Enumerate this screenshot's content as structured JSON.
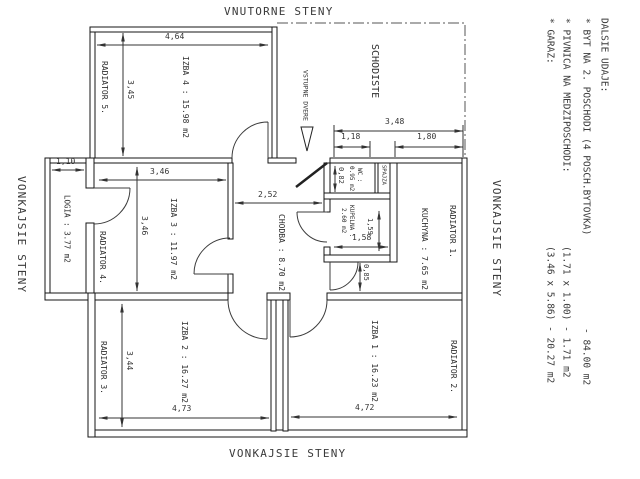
{
  "drawing": {
    "wall_labels": {
      "top": "VNUTORNE STENY",
      "left": "VONKAJSIE STENY",
      "right": "VONKAJSIE STENY",
      "bottom": "VONKAJSIE STENY"
    },
    "staircase_label": "SCHODISTE",
    "entrance_label": "VSTUPNE DVERE",
    "rooms": [
      {
        "id": "izba4",
        "label": "IZBA 4 : 15.98 m2"
      },
      {
        "id": "izba3",
        "label": "IZBA 3 : 11.97 m2"
      },
      {
        "id": "izba2",
        "label": "IZBA 2 : 16.27 m2"
      },
      {
        "id": "izba1",
        "label": "IZBA 1 : 16.23 m2"
      },
      {
        "id": "logia",
        "label": "LOGIA : 3.77 m2"
      },
      {
        "id": "chodba",
        "label": "CHODBA : 8.70 m2"
      },
      {
        "id": "kuchyna",
        "label": "KUCHYNA : 7.65 m2"
      },
      {
        "id": "wc",
        "label_line1": "WC :",
        "label_line2": "0.95 m2"
      },
      {
        "id": "kupelna",
        "label_line1": "KUPELNA :",
        "label_line2": "2.60 m2"
      },
      {
        "id": "spajza",
        "label": "SPAJZA"
      }
    ],
    "radiators": [
      "RADIATOR 1.",
      "RADIATOR 2.",
      "RADIATOR 3.",
      "RADIATOR 4.",
      "RADIATOR 5."
    ],
    "dimensions": [
      {
        "text": "4,64"
      },
      {
        "text": "3,45"
      },
      {
        "text": "1,10"
      },
      {
        "text": "3,46"
      },
      {
        "text": "3,46"
      },
      {
        "text": "2,52"
      },
      {
        "text": "0,82"
      },
      {
        "text": "1,58"
      },
      {
        "text": "1,59"
      },
      {
        "text": "0,85"
      },
      {
        "text": "3,48"
      },
      {
        "text": "1,18"
      },
      {
        "text": "1,80"
      },
      {
        "text": "3,44"
      },
      {
        "text": "4,73"
      },
      {
        "text": "4,72"
      }
    ],
    "notes": {
      "title": "DALSIE UDAJE:",
      "items": [
        {
          "text": "* BYT NA 2. POSCHODI (4 POSCH.BYTOVKA)",
          "value": "- 84.00 m2"
        },
        {
          "text": "* PIVNICA NA MEDZIPOSCHODI:",
          "value": "(1.71 x 1.00) - 1.71 m2"
        },
        {
          "text": "* GARAZ:",
          "value": "(3.46 x 5.86) - 20.27 m2"
        }
      ]
    }
  }
}
